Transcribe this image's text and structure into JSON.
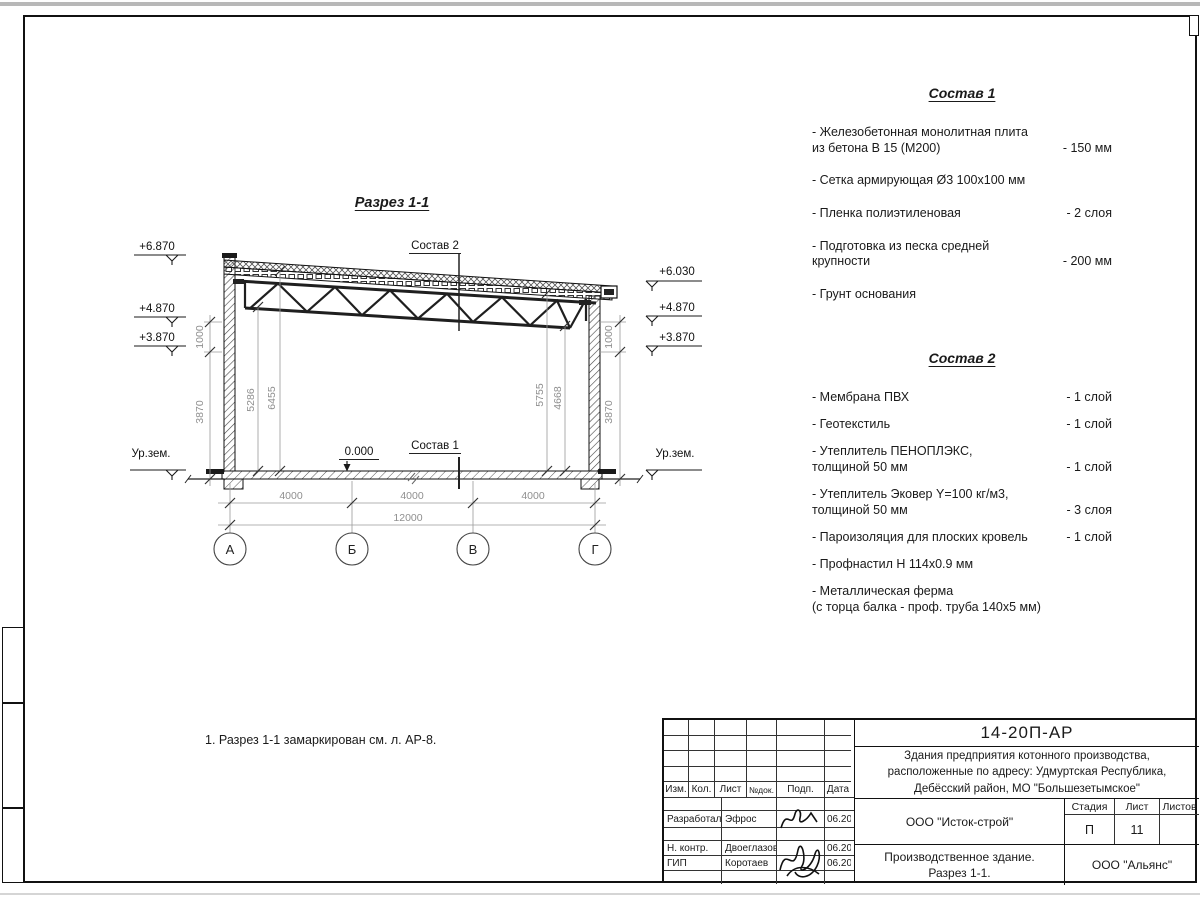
{
  "drawing": {
    "title": "Разрез 1-1",
    "label_sostav1": "Состав 1",
    "label_sostav2": "Состав 2",
    "label_zero": "0.000",
    "ground": "Ур.зем.",
    "elev_left": [
      "+6.870",
      "+4.870",
      "+3.870"
    ],
    "elev_right": [
      "+6.030",
      "+4.870",
      "+3.870"
    ],
    "dims": {
      "left_1000": "1000",
      "left_3870": "3870",
      "in_5286": "5286",
      "in_6455": "6455",
      "in_5755": "5755",
      "in_4668": "4668",
      "right_1000": "1000",
      "right_3870": "3870",
      "span1": "4000",
      "span2": "4000",
      "span3": "4000",
      "total": "12000"
    },
    "axes": [
      "А",
      "Б",
      "В",
      "Г"
    ]
  },
  "sostav1": {
    "title": "Состав 1",
    "items": [
      {
        "name": "- Железобетонная  монолитная плита\nиз бетона В 15 (М200)",
        "value": "- 150 мм"
      },
      {
        "name": "- Сетка армирующая Ø3 100х100 мм",
        "value": ""
      },
      {
        "name": "- Пленка полиэтиленовая",
        "value": "-  2 слоя"
      },
      {
        "name": "- Подготовка из песка средней\nкрупности",
        "value": "- 200 мм"
      },
      {
        "name": "- Грунт основания",
        "value": ""
      }
    ]
  },
  "sostav2": {
    "title": "Состав 2",
    "items": [
      {
        "name": "- Мембрана ПВХ",
        "value": "- 1 слой"
      },
      {
        "name": "- Геотекстиль",
        "value": "- 1 слой"
      },
      {
        "name": "- Утеплитель ПЕНОПЛЭКС,\nтолщиной 50 мм",
        "value": "- 1 слой"
      },
      {
        "name": "- Утеплитель Эковер Y=100 кг/м3,\nтолщиной 50 мм",
        "value": "- 3 слоя"
      },
      {
        "name": "- Пароизоляция для плоских кровель",
        "value": "- 1 слой"
      },
      {
        "name": "- Профнастил Н 114х0.9 мм",
        "value": ""
      },
      {
        "name": "- Металлическая ферма\n(с торца балка - проф. труба 140х5 мм)",
        "value": ""
      }
    ]
  },
  "note": "1. Разрез 1-1 замаркирован см. л. АР-8.",
  "titleblock": {
    "doc_number": "14-20П-АР",
    "project": "Здания предприятия котонного производства,\nрасположенные по адресу: Удмуртская Республика,\nДебёсский район, МО \"Большезетымское\"",
    "header": {
      "izm": "Изм.",
      "kol": "Кол.",
      "list": "Лист",
      "ndok": "№док.",
      "podp": "Подп.",
      "data": "Дата"
    },
    "rows": [
      {
        "role": "Разработал",
        "name": "Эфрос",
        "date": "06.20"
      },
      {
        "role": "Н. контр.",
        "name": "Двоеглазов",
        "date": "06.20"
      },
      {
        "role": "ГИП",
        "name": "Коротаев",
        "date": "06.20"
      }
    ],
    "org1": "ООО \"Исток-строй\"",
    "sheet_title": "Производственное здание.\nРазрез 1-1.",
    "org2": "ООО \"Альянс\"",
    "stage_header": {
      "stage": "Стадия",
      "sheet": "Лист",
      "sheets": "Листов"
    },
    "stage": "П",
    "sheet_num": "11",
    "sheets_total": ""
  }
}
